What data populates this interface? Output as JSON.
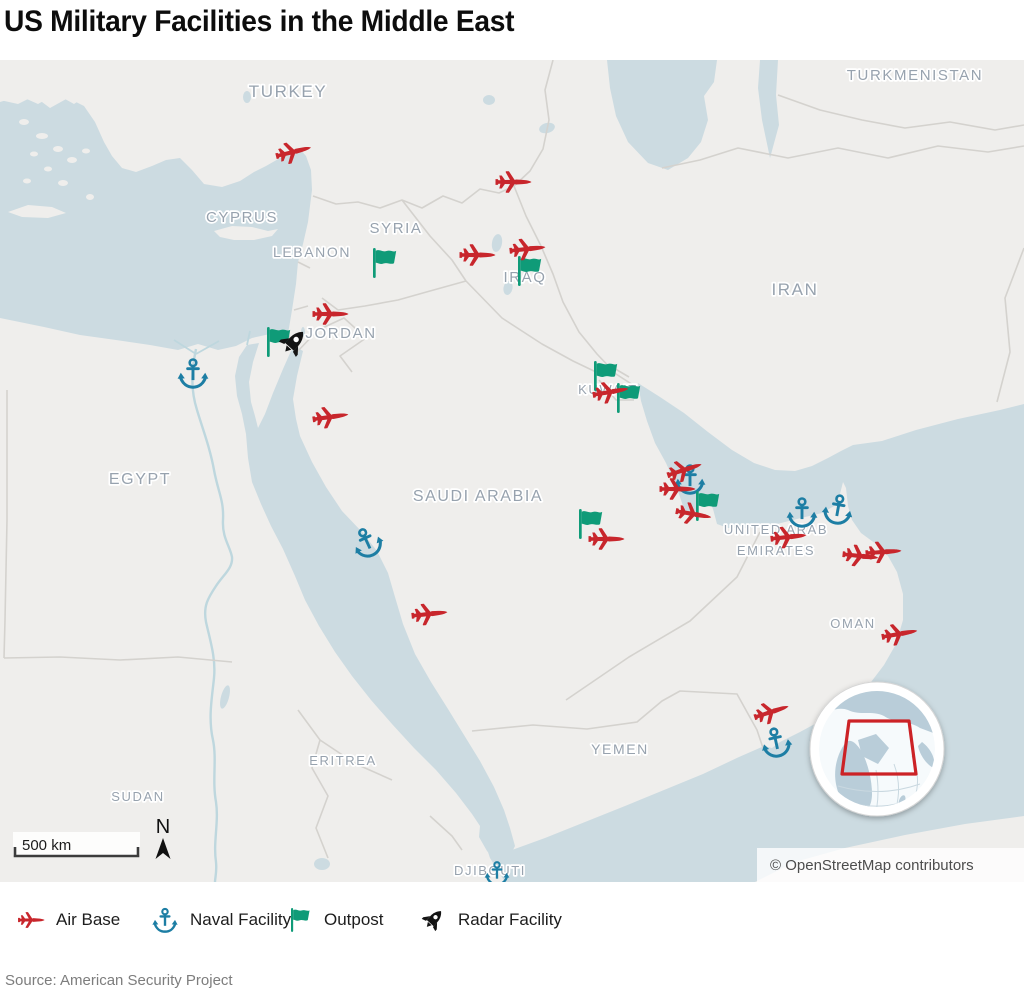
{
  "title": "US Military Facilities in the Middle East",
  "source": "Source: American Security Project",
  "map": {
    "attribution": "© OpenStreetMap contributors",
    "scale_bar": {
      "label": "500 km"
    },
    "north_label": "N",
    "country_labels": [
      {
        "text": "TURKEY",
        "x": 288,
        "y": 97,
        "size": 17
      },
      {
        "text": "TURKMENISTAN",
        "x": 915,
        "y": 80,
        "size": 15
      },
      {
        "text": "CYPRUS",
        "x": 242,
        "y": 222,
        "size": 15
      },
      {
        "text": "SYRIA",
        "x": 396,
        "y": 233,
        "size": 15
      },
      {
        "text": "LEBANON",
        "x": 312,
        "y": 257,
        "size": 14
      },
      {
        "text": "IRAQ",
        "x": 525,
        "y": 282,
        "size": 15
      },
      {
        "text": "IRAN",
        "x": 795,
        "y": 295,
        "size": 17
      },
      {
        "text": "JORDAN",
        "x": 341,
        "y": 338,
        "size": 15
      },
      {
        "text": "KUWAIT",
        "x": 608,
        "y": 394,
        "size": 13
      },
      {
        "text": "EGYPT",
        "x": 140,
        "y": 484,
        "size": 16
      },
      {
        "text": "SAUDI ARABIA",
        "x": 478,
        "y": 501,
        "size": 16
      },
      {
        "text": "UNITED ARAB",
        "x": 776,
        "y": 534,
        "size": 13
      },
      {
        "text": "EMIRATES",
        "x": 776,
        "y": 555,
        "size": 13
      },
      {
        "text": "OMAN",
        "x": 853,
        "y": 628,
        "size": 13
      },
      {
        "text": "YEMEN",
        "x": 620,
        "y": 754,
        "size": 14
      },
      {
        "text": "ERITREA",
        "x": 343,
        "y": 765,
        "size": 13
      },
      {
        "text": "SUDAN",
        "x": 138,
        "y": 801,
        "size": 13
      },
      {
        "text": "DJIBOUTI",
        "x": 490,
        "y": 875,
        "size": 13
      }
    ],
    "facilities": {
      "naval_facility": {
        "label": "Naval Facility",
        "color": "#1d7ea4",
        "points": [
          [
            193,
            373,
            0
          ],
          [
            367,
            542,
            -25
          ],
          [
            690,
            479,
            0
          ],
          [
            802,
            512,
            0
          ],
          [
            838,
            509,
            10
          ],
          [
            776,
            742,
            -12
          ],
          [
            497,
            873,
            0,
            0.8
          ]
        ]
      },
      "outpost": {
        "label": "Outpost",
        "color": "#0f9b78",
        "points": [
          [
            383,
            263,
            0
          ],
          [
            277,
            342,
            0
          ],
          [
            528,
            271,
            0
          ],
          [
            604,
            376,
            0
          ],
          [
            627,
            398,
            0
          ],
          [
            589,
            524,
            0
          ],
          [
            706,
            506,
            0
          ]
        ]
      },
      "air_base": {
        "label": "Air Base",
        "color": "#c8262c",
        "points": [
          [
            293,
            152,
            -14
          ],
          [
            513,
            182,
            0
          ],
          [
            477,
            255,
            0
          ],
          [
            527,
            249,
            -6
          ],
          [
            330,
            314,
            0
          ],
          [
            330,
            417,
            -8
          ],
          [
            610,
            392,
            -10
          ],
          [
            684,
            470,
            -18
          ],
          [
            677,
            489,
            0
          ],
          [
            693,
            514,
            10
          ],
          [
            606,
            539,
            0
          ],
          [
            788,
            537,
            -6
          ],
          [
            860,
            556,
            6
          ],
          [
            883,
            552,
            -4
          ],
          [
            429,
            614,
            -6
          ],
          [
            899,
            634,
            -10
          ],
          [
            771,
            712,
            -18
          ]
        ]
      },
      "radar_facility": {
        "label": "Radar Facility",
        "color": "#141414",
        "points": [
          [
            293,
            343,
            0
          ]
        ]
      }
    },
    "inset": {
      "extent_color": "#cc2127"
    }
  },
  "legend": {
    "items": [
      {
        "type": "air_base",
        "label": "Air Base"
      },
      {
        "type": "naval_facility",
        "label": "Naval Facility"
      },
      {
        "type": "outpost",
        "label": "Outpost"
      },
      {
        "type": "radar_facility",
        "label": "Radar Facility"
      }
    ]
  }
}
